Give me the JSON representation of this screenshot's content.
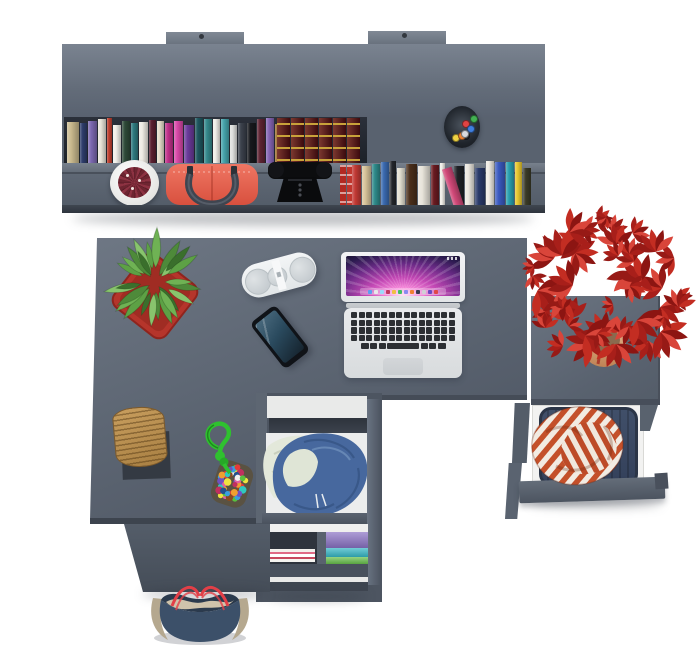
{
  "scene": {
    "description": "Top-down 3D render of a gray L-shaped desk with wall hutch, open drawers, laptop and decor on a white floor",
    "background": "#ffffff",
    "furniture_gray_top": "#6b7481",
    "furniture_gray_face": "#59626f",
    "furniture_gray_dark": "#454c57"
  },
  "hutch": {
    "upper_books": [
      [
        "#c9b98d",
        12
      ],
      [
        "#2e3d6b",
        7
      ],
      [
        "#7b68b0",
        9
      ],
      [
        "#e8e4d8",
        8
      ],
      [
        "#c04030",
        5
      ],
      [
        "#f2f0ea",
        8
      ],
      [
        "#2e4a38",
        8
      ],
      [
        "#2e7a80",
        7
      ],
      [
        "#efece4",
        9
      ],
      [
        "#5a2030",
        7
      ],
      [
        "#e4ddca",
        7
      ],
      [
        "#c0308a",
        8
      ],
      [
        "#d848a8",
        9
      ],
      [
        "#6a3a9a",
        10
      ],
      [
        "#1e565e",
        8
      ],
      [
        "#35898c",
        8
      ],
      [
        "#f0eee8",
        7
      ],
      [
        "#46a4ac",
        8
      ],
      [
        "#dfe0de",
        7
      ],
      [
        "#3c424d",
        8
      ],
      [
        "#17191d",
        9
      ],
      [
        "#5e2433",
        8
      ],
      [
        "#8565b5",
        8
      ],
      [
        "#9a6a28",
        9
      ]
    ],
    "classic_set": {
      "count": 6,
      "color": "#5c1016",
      "band": "#c9a23a"
    },
    "red_books": [
      "#b22a22",
      "#c0352c",
      "#a82620"
    ],
    "lower_books": [
      [
        "#c23a34",
        9,
        0
      ],
      [
        "#d8c49a",
        9,
        0
      ],
      [
        "#2e8a8a",
        8,
        0
      ],
      [
        "#3a6ab0",
        8,
        0
      ],
      [
        "#23262b",
        6,
        0
      ],
      [
        "#e4e0d2",
        8,
        0
      ],
      [
        "#4a2e1a",
        11,
        0
      ],
      [
        "#e8e4da",
        12,
        0
      ],
      [
        "#6a1a20",
        8,
        0
      ],
      [
        "#f0eee8",
        5,
        0
      ],
      [
        "#d04878",
        10,
        1
      ],
      [
        "#1e2126",
        10,
        0
      ],
      [
        "#ece8e0",
        9,
        0
      ],
      [
        "#2a3a6a",
        10,
        0
      ],
      [
        "#f0ece4",
        8,
        0
      ],
      [
        "#3a5ac0",
        10,
        0
      ],
      [
        "#2aa0b0",
        8,
        0
      ],
      [
        "#e8c830",
        7,
        0
      ],
      [
        "#3a3a28",
        8,
        0
      ]
    ],
    "pencil_cup": {
      "cup": "#1d2127",
      "pencils": [
        "#e04343",
        "#3f7fe0",
        "#43b153",
        "#efd344",
        "#23262b",
        "#ee8334",
        "#d8dade"
      ]
    }
  },
  "desk_items": {
    "laptop": {
      "body": "#e3e5e7",
      "keys": "#2c2f33",
      "trackpad": "#ced2d5",
      "keyboard": {
        "rows": 4,
        "cols": 14,
        "bottom": [
          8,
          7,
          7,
          32,
          7,
          7,
          8
        ]
      },
      "wallpaper": [
        "#ffe2f2",
        "#f585d8",
        "#c247b4",
        "#6a2a86",
        "#2a1a4e",
        "#151029"
      ],
      "dock_icons": [
        "#5aa0f0",
        "#e8e8ea",
        "#9adafa",
        "#c03a60",
        "#f0c040",
        "#40c060",
        "#8a8af0",
        "#f08030",
        "#3a3a50",
        "#d0d0d4",
        "#6a4ac0",
        "#e04848"
      ]
    },
    "speaker": {
      "body": "#edf0f2",
      "grille": "#d2d7da"
    },
    "phone": {
      "body": "#14171b",
      "screen_top": "#4a6a7e",
      "screen_bottom": "#16242f"
    },
    "green_plant": {
      "pot": "#b5352b",
      "pot_edge": "#8f241d",
      "leaves": 26,
      "leaf_colors": [
        "#6fb254",
        "#4e8a3a",
        "#88c46d",
        "#3a6f2c",
        "#5da145"
      ]
    },
    "red_plant": {
      "pot": "#d9a87e",
      "pot_dark": "#bf8355",
      "leaves": 46,
      "leaf_colors": [
        "#a81f1a",
        "#c32d22",
        "#8c1512",
        "#d9453a",
        "#971a16"
      ]
    }
  },
  "storage": {
    "white_planter": {
      "pot": "#f4f4f2",
      "plant": "#7a2836"
    },
    "red_handbag": {
      "body": "#e2614e",
      "handles": "#41474f"
    },
    "camera": {
      "body": "#0b0c0e",
      "detail": "#44474e"
    },
    "center_drawer": {
      "interior": "#eceded",
      "jacket": "#47689e",
      "jacket_fold": "#2e4a78",
      "cloth": "#e3e8da"
    },
    "folded_clothes": {
      "purple": "#8a72c4",
      "teal": "#35b7c6",
      "green": "#68c04c"
    },
    "right_drawer": {
      "basket": "#39455a",
      "stripe": "#c4502a",
      "stripe_base": "#f2ebe2"
    },
    "wicker_basket": {
      "straw": "#b8904f",
      "mat": "#343a43"
    },
    "rope_toy": {
      "rope": "#2fc12f",
      "pouch": "#5a5242",
      "pompom_count": 42,
      "pompoms": [
        "#e43a3a",
        "#f0a030",
        "#efe23f",
        "#58c040",
        "#38a0e0",
        "#7050c0",
        "#e060a0",
        "#f2f2f2",
        "#8a4a20",
        "#30c8c0",
        "#c03060",
        "#24508e"
      ]
    },
    "tote_bag": {
      "navy": "#3c5069",
      "tan": "#b5a88f",
      "tan_inner": "#cfc3ab",
      "interior": "#2b3a4d",
      "straps": "#e23f47"
    }
  }
}
